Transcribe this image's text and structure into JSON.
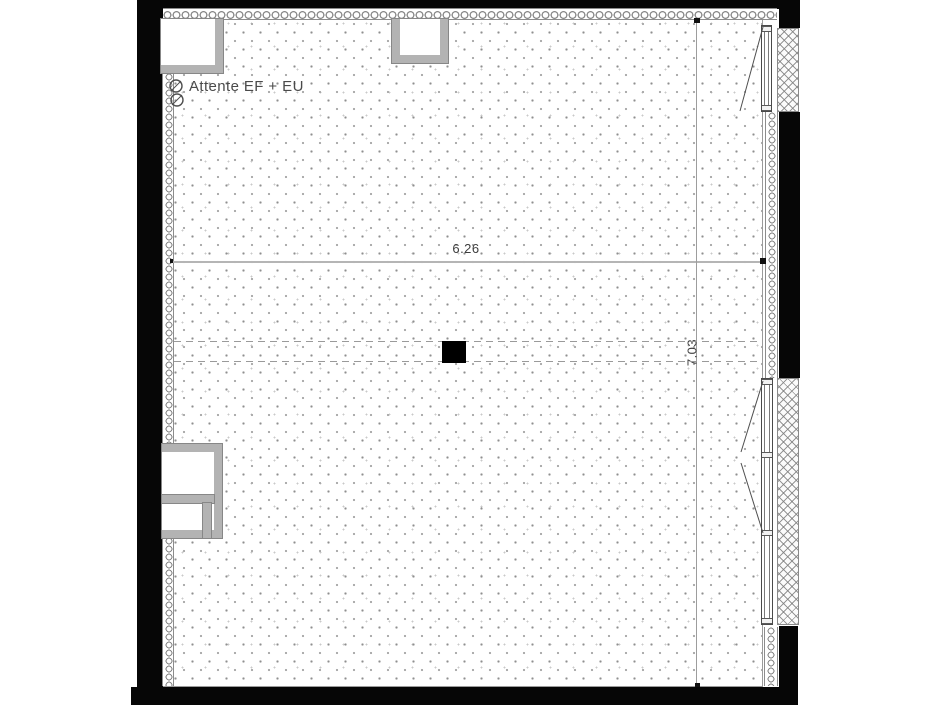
{
  "plan": {
    "annotation": {
      "label": "Attente EF + EU",
      "symbol": "pipe-connection-circles"
    },
    "dimensions": {
      "horizontal": {
        "label": "6.26",
        "value_m": 6.26
      },
      "vertical": {
        "label": "7.03",
        "value_m": 7.03
      }
    },
    "colors": {
      "wall": "#060606",
      "insulation_outline": "#8a8a8a",
      "niche_fill": "#b3b3b3",
      "dimension_line": "#b5b5b5",
      "dimension_text": "#3d3d3d",
      "annotation_text": "#4a4a4a",
      "floor_stipple": "#8f8f8f"
    }
  }
}
